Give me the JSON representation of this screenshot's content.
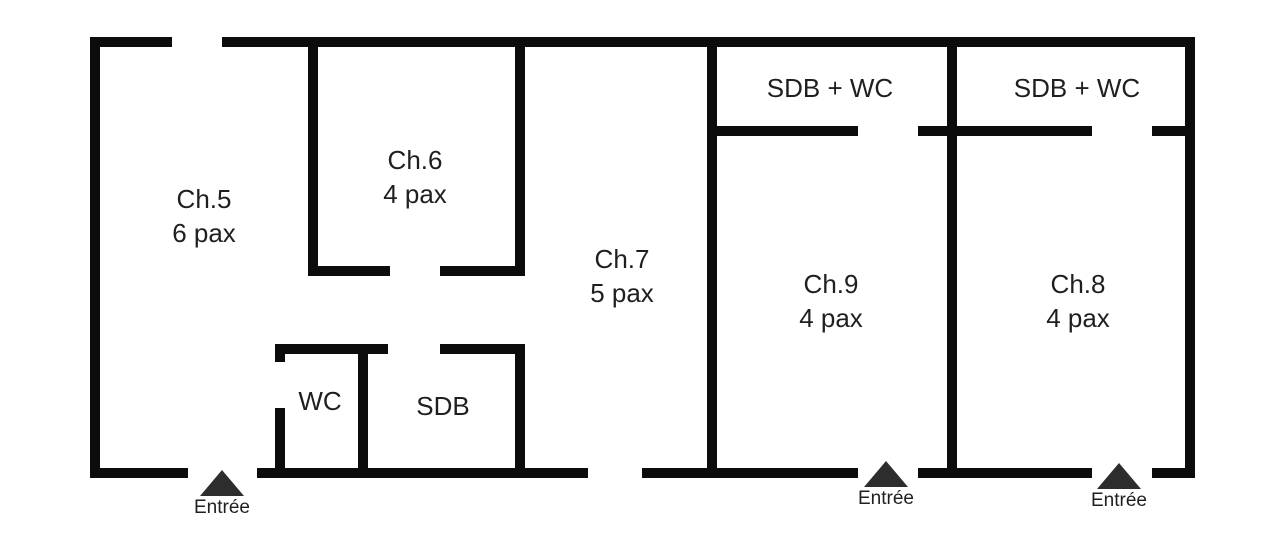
{
  "diagram": {
    "type": "floor-plan",
    "background_color": "#ffffff",
    "wall_color": "#0c0c0c",
    "text_color": "#1f1f1f",
    "entrance_marker_color": "#2d2d2d"
  },
  "rooms": {
    "ch5": {
      "name": "Ch.5",
      "capacity": "6 pax"
    },
    "ch6": {
      "name": "Ch.6",
      "capacity": "4 pax"
    },
    "ch7": {
      "name": "Ch.7",
      "capacity": "5 pax"
    },
    "ch9": {
      "name": "Ch.9",
      "capacity": "4 pax"
    },
    "ch8": {
      "name": "Ch.8",
      "capacity": "4 pax"
    },
    "bathroom_ch9": {
      "name": "SDB + WC"
    },
    "bathroom_ch8": {
      "name": "SDB + WC"
    },
    "wc": {
      "name": "WC"
    },
    "sdb": {
      "name": "SDB"
    }
  },
  "entrances": {
    "main": {
      "label": "Entrée"
    },
    "ch9": {
      "label": "Entrée"
    },
    "ch8": {
      "label": "Entrée"
    }
  }
}
